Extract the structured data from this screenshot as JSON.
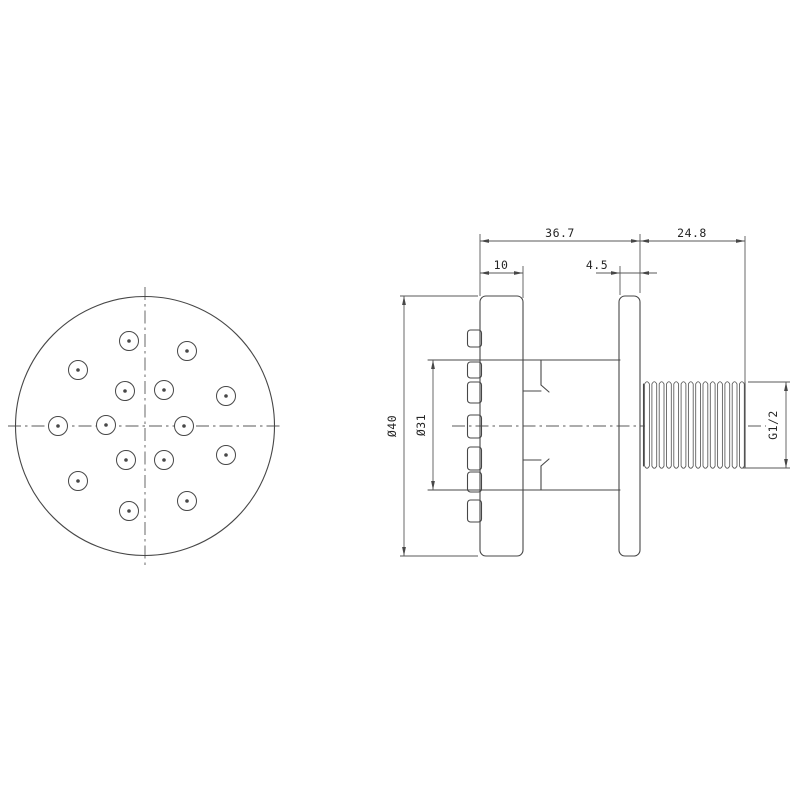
{
  "page": {
    "background": "#ffffff"
  },
  "style": {
    "outline_color": "#474747",
    "thin_color": "#585858",
    "text_color": "#252525"
  },
  "dimensions": {
    "top_width": "36.7",
    "thread_length": "24.8",
    "faceplate_thickness": "10",
    "flange_thickness": "4.5",
    "outer_diameter": "Ø40",
    "body_diameter": "Ø31",
    "thread_spec": "G1/2"
  },
  "front_view": {
    "center": [
      145,
      426
    ],
    "radius": 129.5,
    "nozzle_radius": 9.5,
    "nozzle_dot_radius": 1.8,
    "nozzles": [
      [
        129,
        341
      ],
      [
        187,
        351
      ],
      [
        78,
        370
      ],
      [
        125,
        391
      ],
      [
        164,
        390
      ],
      [
        226,
        396
      ],
      [
        58,
        426
      ],
      [
        106,
        425
      ],
      [
        184,
        426
      ],
      [
        126,
        460
      ],
      [
        164,
        460
      ],
      [
        226,
        455
      ],
      [
        78,
        481
      ],
      [
        187,
        501
      ],
      [
        129,
        511
      ]
    ],
    "centerlines": [
      [
        8,
        426,
        283,
        426
      ],
      [
        145,
        287,
        145,
        565
      ]
    ]
  },
  "side_view": {
    "centerlines": [
      [
        452,
        426,
        646,
        426
      ],
      [
        748,
        426,
        766,
        426
      ]
    ],
    "plates": [
      {
        "name": "faceplate",
        "x": 480,
        "y": 296,
        "w": 43,
        "h": 260,
        "r": 6
      },
      {
        "name": "wall-flange",
        "x": 619,
        "y": 296,
        "w": 21,
        "h": 260,
        "r": 6
      }
    ],
    "tabs": {
      "x": 467.5,
      "w": 14,
      "r": 3,
      "spans": [
        [
          330,
          347
        ],
        [
          362,
          378
        ],
        [
          382,
          403
        ],
        [
          415,
          438
        ],
        [
          447,
          470
        ],
        [
          472,
          492
        ],
        [
          500,
          522
        ]
      ]
    },
    "lines": [
      [
        428,
        360,
        620,
        360
      ],
      [
        428,
        490,
        620,
        490
      ],
      [
        523,
        391,
        541,
        391
      ],
      [
        523,
        460,
        541,
        460
      ],
      [
        541,
        360,
        541,
        385
      ],
      [
        541,
        466,
        541,
        490
      ],
      [
        541,
        385,
        549,
        392
      ],
      [
        541,
        466,
        549,
        459
      ],
      [
        643.5,
        384,
        643.5,
        466
      ],
      [
        745,
        382,
        745,
        468
      ]
    ],
    "thread": {
      "x0": 647,
      "dx": 7.3,
      "count": 14,
      "hw": 2.4,
      "top": 384,
      "bot": 466,
      "cap": 4.5
    }
  },
  "dims": {
    "ext_lines": [
      [
        480,
        234,
        480,
        296
      ],
      [
        523,
        266,
        523,
        298
      ],
      [
        620,
        266,
        620,
        295
      ],
      [
        640,
        234,
        640,
        293
      ],
      [
        745,
        236,
        745,
        384
      ],
      [
        400,
        296,
        478,
        296
      ],
      [
        400,
        556,
        478,
        556
      ],
      [
        748,
        382,
        790,
        382
      ],
      [
        743,
        468,
        790,
        468
      ]
    ],
    "horizontal": [
      {
        "key": "top_width",
        "y": 241,
        "x1": 480,
        "x2": 640,
        "arrows": [
          [
            480,
            1
          ],
          [
            640,
            -1
          ]
        ],
        "tx": 560,
        "ty": 237
      },
      {
        "key": "thread_length",
        "y": 241,
        "x1": 640,
        "x2": 745,
        "arrows": [
          [
            640,
            1
          ],
          [
            745,
            -1
          ]
        ],
        "tx": 692,
        "ty": 237
      },
      {
        "key": "faceplate_thickness",
        "y": 273,
        "x1": 480,
        "x2": 523,
        "arrows": [
          [
            480,
            1
          ],
          [
            523,
            -1
          ]
        ],
        "tx": 501,
        "ty": 269
      },
      {
        "key": "flange_thickness",
        "y": 273,
        "x1": 596,
        "x2": 657,
        "arrows": [
          [
            620,
            -1
          ],
          [
            640,
            1
          ]
        ],
        "tx": 597,
        "ty": 269
      }
    ],
    "vertical": [
      {
        "key": "outer_diameter",
        "x": 404,
        "y1": 296,
        "y2": 556,
        "tx": 396,
        "ty": 426
      },
      {
        "key": "body_diameter",
        "x": 433,
        "y1": 360,
        "y2": 490,
        "tx": 425,
        "ty": 425
      },
      {
        "key": "thread_spec",
        "x": 786,
        "y1": 382,
        "y2": 468,
        "tx": 777,
        "ty": 425
      }
    ]
  }
}
